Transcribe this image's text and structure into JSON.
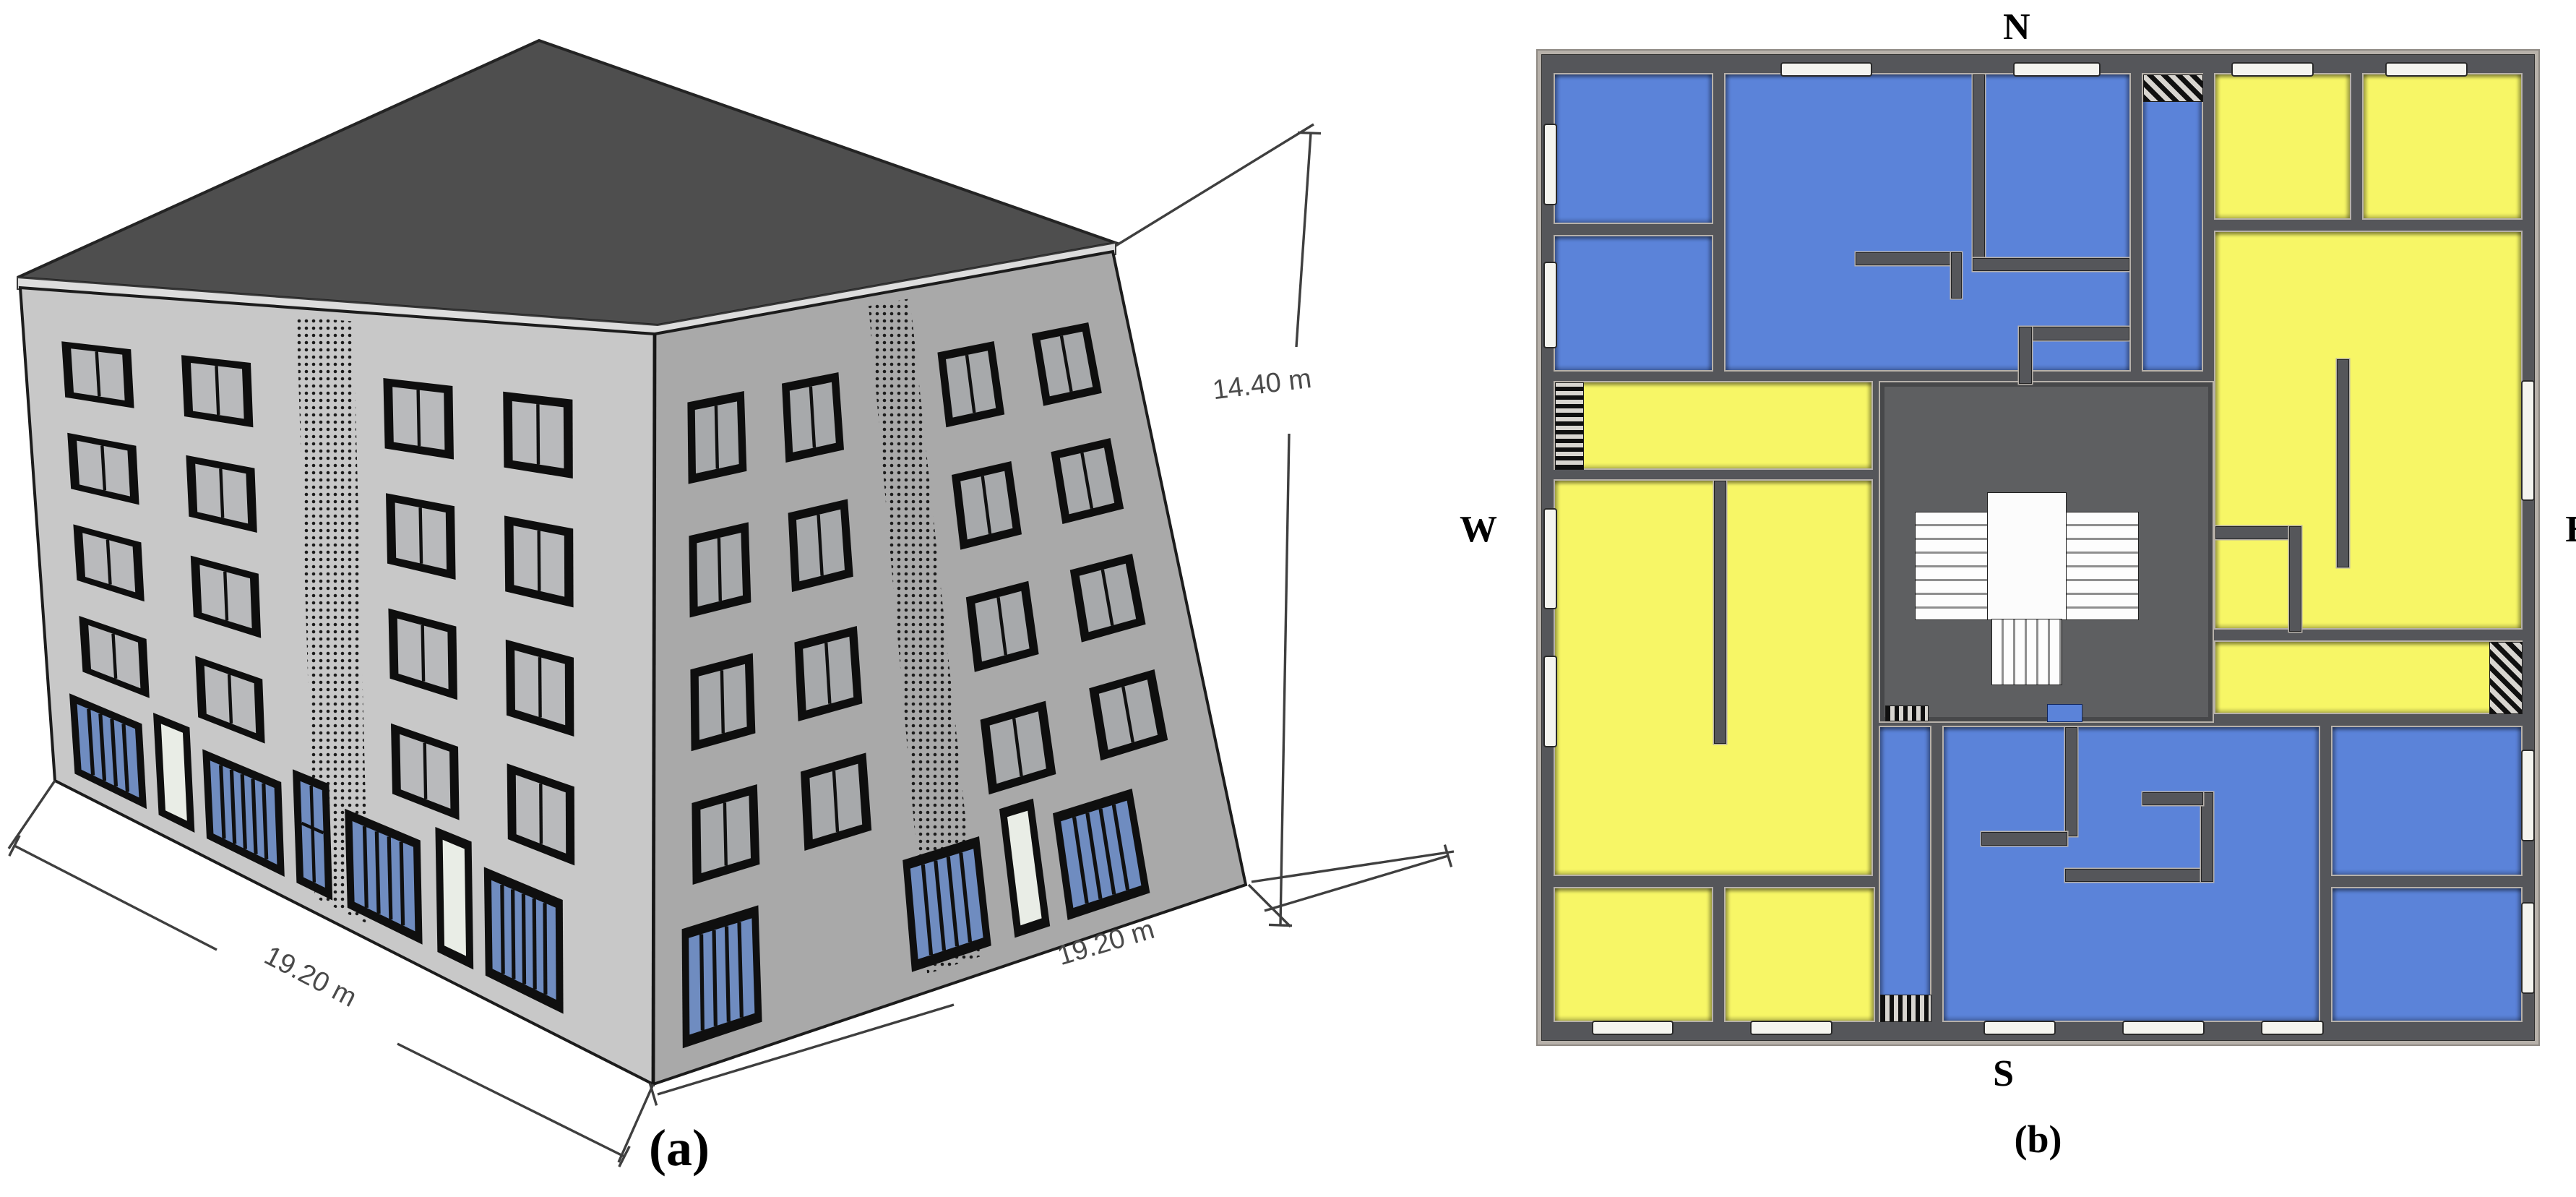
{
  "panel_a": {
    "caption": "(a)",
    "dim_width_left": "19.20 m",
    "dim_width_right": "19.20 m",
    "dim_height": "14.40 m"
  },
  "panel_b": {
    "caption": "(b)",
    "compass_north": "N",
    "compass_south": "S",
    "compass_west": "W",
    "compass_east": "E"
  },
  "colors": {
    "room_blue": "#5b83d9",
    "room_yellow": "#f7f666",
    "wall_dark": "#55565a",
    "wall_light": "#b7b1aa",
    "core_gray": "#5e5f61",
    "roof_gray": "#4e4e4e",
    "facade_light": "#c8c8c8",
    "facade_shade": "#a9a9a9",
    "window_glass": "#b9babc",
    "storefront_glass": "#6f8cc0",
    "door_white": "#e9ede6"
  }
}
